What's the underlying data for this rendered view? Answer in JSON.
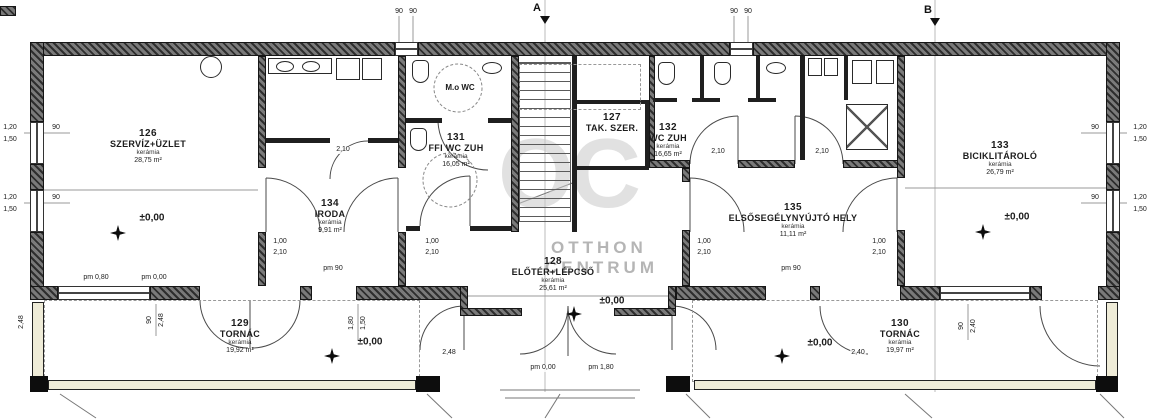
{
  "watermark": {
    "logo": "OC",
    "line1": "OTTHON",
    "line2": "CENTRUM"
  },
  "markers": {
    "a": "A",
    "b": "B"
  },
  "labels": {
    "mo_wc": "M.o WC"
  },
  "rooms": [
    {
      "number": "126",
      "name": "SZERVÍZ+ÜZLET",
      "material": "kerámia",
      "area": "28,75 m²",
      "level": "±0,00"
    },
    {
      "number": "134",
      "name": "IRODA",
      "material": "kerámia",
      "area": "9,91 m²"
    },
    {
      "number": "131",
      "name": "FFI WC ZUH",
      "material": "kerámia",
      "area": "16,05 m²"
    },
    {
      "number": "127",
      "name": "TAK. SZER."
    },
    {
      "number": "132",
      "name": "WC ZUH",
      "material": "kerámia",
      "area": "16,65 m²"
    },
    {
      "number": "135",
      "name": "ELSŐSEGÉLYNYÚJTÓ HELY",
      "material": "kerámia",
      "area": "11,11 m²"
    },
    {
      "number": "133",
      "name": "BICIKLITÁROLÓ",
      "material": "kerámia",
      "area": "26,79 m²",
      "level": "±0,00"
    },
    {
      "number": "128",
      "name": "ELŐTÉR+LÉPCSŐ",
      "material": "kerámia",
      "area": "25,61 m²",
      "level": "±0,00"
    },
    {
      "number": "129",
      "name": "TORNÁC",
      "material": "kerámia",
      "area": "19,92 m²",
      "level": "±0,00"
    },
    {
      "number": "130",
      "name": "TORNÁC",
      "material": "kerámia",
      "area": "19,97 m²",
      "level": "±0,00"
    }
  ],
  "dims": [
    "1,20",
    "1,50",
    "90",
    "1,20",
    "1,50",
    "90",
    "1,20",
    "1,50",
    "90",
    "1,20",
    "1,50",
    "90",
    "90",
    "90",
    "90",
    "90",
    "1,00",
    "2,10",
    "1,00",
    "2,10",
    "pm 90",
    "1,00",
    "2,10",
    "1,00",
    "2,10",
    "pm 90",
    "2,10",
    "2,10",
    "2,10",
    "pm 0,80",
    "pm 0,00",
    "pm 0,00",
    "pm 1,80",
    "2,48",
    "1,80",
    "1,50",
    "90",
    "2,40",
    "2,48",
    "2,40",
    "90",
    "2,48"
  ]
}
